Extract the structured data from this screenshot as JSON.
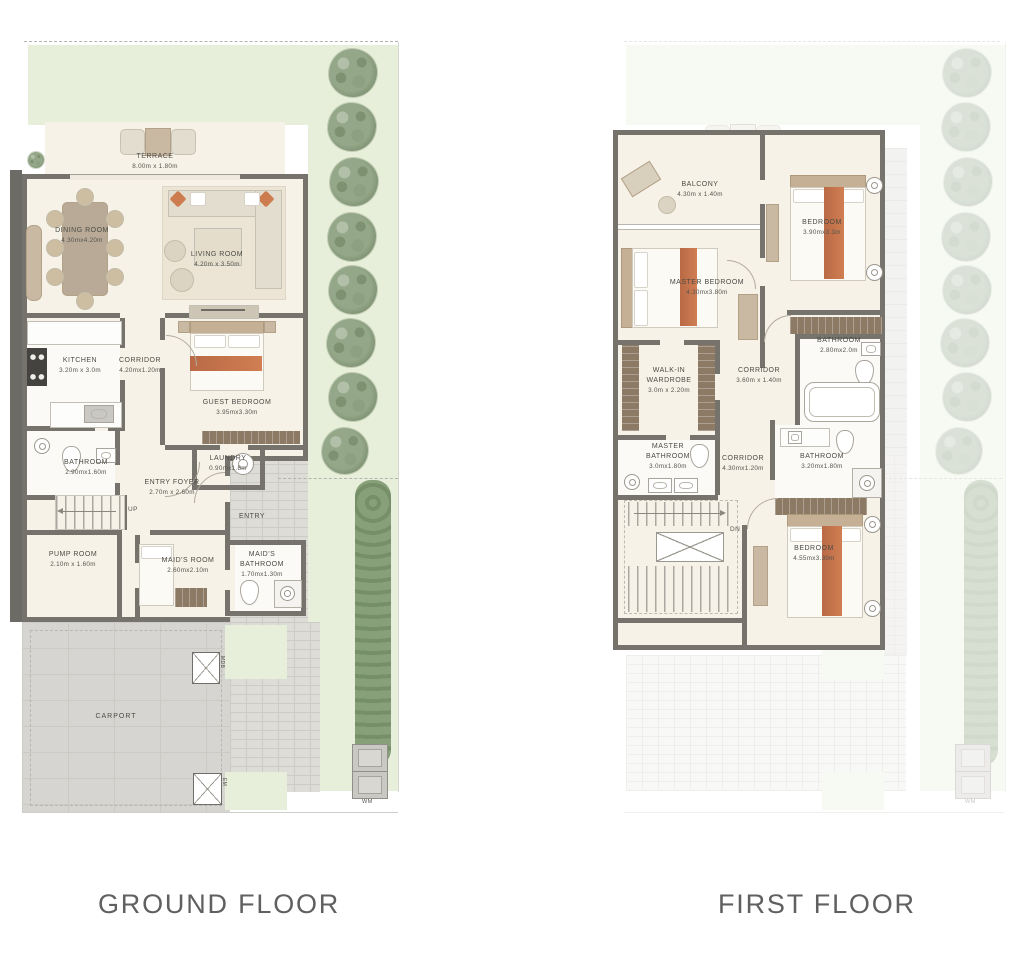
{
  "captions": {
    "ground": "GROUND FLOOR",
    "first": "FIRST FLOOR"
  },
  "ground_floor": {
    "terrace": {
      "name": "TERRACE",
      "dims": "8.00m x 1.80m"
    },
    "dining_room": {
      "name": "DINING ROOM",
      "dims": "4.30mx4.20m"
    },
    "living_room": {
      "name": "LIVING ROOM",
      "dims": "4.20m x 3.50m"
    },
    "kitchen": {
      "name": "KITCHEN",
      "dims": "3.20m x 3.0m"
    },
    "corridor": {
      "name": "CORRIDOR",
      "dims": "4.20mx1.20m"
    },
    "guest_bedroom": {
      "name": "GUEST BEDROOM",
      "dims": "3.95mx3.30m"
    },
    "bathroom": {
      "name": "BATHROOM",
      "dims": "2.90mx1.60m"
    },
    "laundry": {
      "name": "LAUNDRY",
      "dims": "0.90mx1.8m"
    },
    "entry_foyer": {
      "name": "ENTRY FOYER",
      "dims": "2.70m x 2.60m"
    },
    "stairs": {
      "label": "UP"
    },
    "entry": {
      "name": "ENTRY"
    },
    "pump_room": {
      "name": "PUMP ROOM",
      "dims": "2.10m x 1.60m"
    },
    "maids_room": {
      "name": "MAID'S ROOM",
      "dims": "2.60mx2.10m"
    },
    "maids_bathroom": {
      "name": "MAID'S BATHROOM",
      "dims": "1.70mx1.30m"
    },
    "carport": {
      "name": "CARPORT"
    },
    "utilities": {
      "mdb": "MDB",
      "em": "EM",
      "wm": "WM"
    }
  },
  "first_floor": {
    "terrace": {
      "name": "TERRACE"
    },
    "balcony": {
      "name": "BALCONY",
      "dims": "4.30m x 1.40m"
    },
    "master_bedroom": {
      "name": "MASTER BEDROOM",
      "dims": "4.30mx3.80m"
    },
    "bedroom_top": {
      "name": "BEDROOM",
      "dims": "3.90mx3.3m"
    },
    "bathroom_top": {
      "name": "BATHROOM",
      "dims": "2.80mx2.0m"
    },
    "corridor_upper": {
      "name": "CORRIDOR",
      "dims": "3.60m x 1.40m"
    },
    "walk_in_wardrobe": {
      "name": "WALK-IN WARDROBE",
      "dims": "3.0m x 2.20m"
    },
    "master_bathroom": {
      "name": "MASTER BATHROOM",
      "dims": "3.0mx1.80m"
    },
    "corridor_lower": {
      "name": "CORRIDOR",
      "dims": "4.30mx1.20m"
    },
    "bathroom_mid": {
      "name": "BATHROOM",
      "dims": "3.20mx1.80m"
    },
    "bedroom_bottom": {
      "name": "BEDROOM",
      "dims": "4.55mx3.30m"
    },
    "stairs": {
      "label": "DN"
    },
    "utilities": {
      "wm": "WM"
    }
  },
  "colors": {
    "wall": "#75736c",
    "interior": "#f7f2e7",
    "wet_room": "#fbfaf6",
    "garden": "#e7eeda",
    "tree": "#8fa383",
    "paving": "#dbdad5",
    "carport": "#d6d5d1",
    "accent_orange": "#c9744d",
    "wardrobe_brown": "#8c7a64",
    "label_text": "#4c4b46",
    "caption_text": "#606060"
  }
}
